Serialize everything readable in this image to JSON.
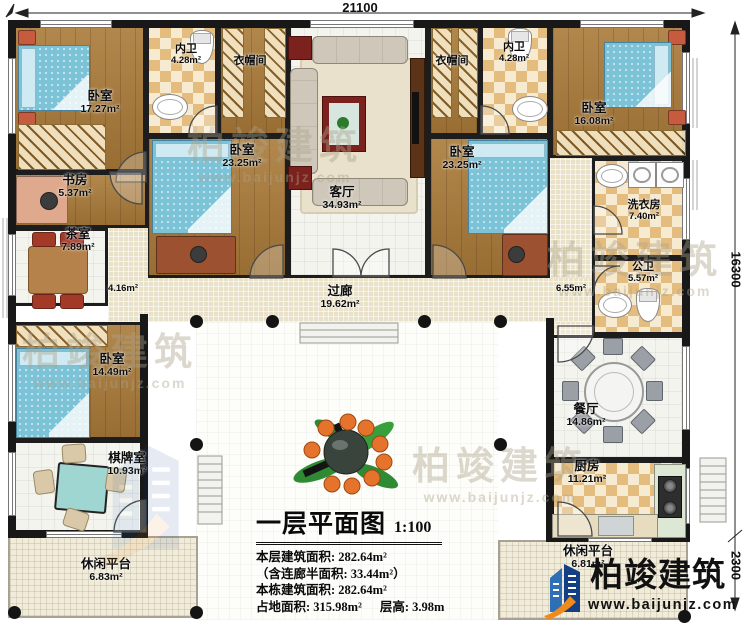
{
  "dimensions": {
    "top": "21100",
    "right_upper": "16300",
    "right_lower": "2300"
  },
  "rooms": {
    "bedroom_top_left": {
      "name": "卧室",
      "area": "17.27m²"
    },
    "study": {
      "name": "书房",
      "area": "5.37m²"
    },
    "tea_room": {
      "name": "茶室",
      "area": "7.89m²"
    },
    "hall_left": {
      "name": "",
      "area": "4.16m²"
    },
    "bedroom_mid_left": {
      "name": "卧室",
      "area": "14.49m²"
    },
    "chess_room": {
      "name": "棋牌室",
      "area": "10.93m²"
    },
    "platform_left": {
      "name": "休闲平台",
      "area": "6.83m²"
    },
    "bath_ensuite_left": {
      "name": "内卫",
      "area": "4.28m²"
    },
    "cloakroom_left": {
      "name": "衣帽间",
      "area": ""
    },
    "bedroom_center_left": {
      "name": "卧室",
      "area": "23.25m²"
    },
    "living_room": {
      "name": "客厅",
      "area": "34.93m²"
    },
    "cloakroom_right": {
      "name": "衣帽间",
      "area": ""
    },
    "bath_ensuite_right": {
      "name": "内卫",
      "area": "4.28m²"
    },
    "bedroom_center_right": {
      "name": "卧室",
      "area": "23.25m²"
    },
    "bedroom_top_right": {
      "name": "卧室",
      "area": "16.08m²"
    },
    "laundry": {
      "name": "洗衣房",
      "area": "7.40m²"
    },
    "hall_right": {
      "name": "",
      "area": "6.55m²"
    },
    "bath_public": {
      "name": "公卫",
      "area": "5.57m²"
    },
    "corridor": {
      "name": "过廊",
      "area": "19.62m²"
    },
    "dining_room": {
      "name": "餐厅",
      "area": "14.86m²"
    },
    "kitchen": {
      "name": "厨房",
      "area": "11.21m²"
    },
    "platform_right": {
      "name": "休闲平台",
      "area": "6.81m²"
    }
  },
  "title_block": {
    "title": "一层平面图",
    "scale": "1:100",
    "line1": "本层建筑面积: 282.64m²",
    "line2": "（含连廊半面积: 33.44m²）",
    "line3": "本栋建筑面积: 282.64m²",
    "line4": "占地面积: 315.98m²",
    "line5": "层高: 3.98m"
  },
  "branding": {
    "logo_text": "柏竣建筑",
    "logo_url": "www.baijunjz.com",
    "watermark_text": "柏竣建筑",
    "watermark_url": "www.baijunjz.com"
  },
  "colors": {
    "wall": "#1d1d1d",
    "wood_floor": "#a97a39",
    "bed_blue": "#7cc3d8",
    "checker_tile": "#e3bc7e",
    "corridor_floor": "#eae2c8",
    "logo_blue": "#143f85",
    "logo_orange": "#ef8b1d"
  }
}
